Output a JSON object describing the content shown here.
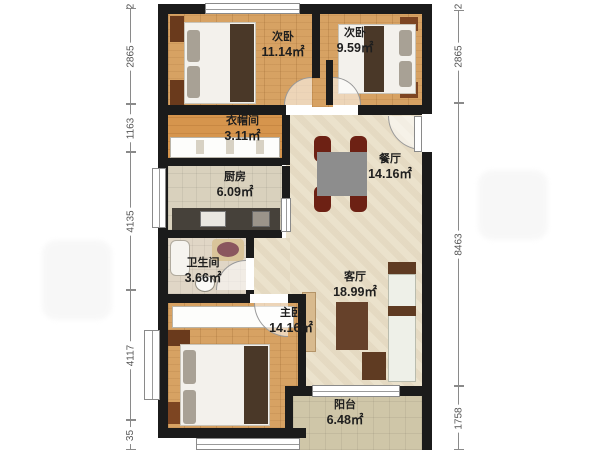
{
  "rooms": [
    {
      "name": "次卧",
      "area": "11.14㎡"
    },
    {
      "name": "次卧",
      "area": "9.59㎡"
    },
    {
      "name": "衣帽间",
      "area": "3.11㎡"
    },
    {
      "name": "厨房",
      "area": "6.09㎡"
    },
    {
      "name": "餐厅",
      "area": "14.16㎡"
    },
    {
      "name": "卫生间",
      "area": "3.66㎡"
    },
    {
      "name": "客厅",
      "area": "18.99㎡"
    },
    {
      "name": "主卧",
      "area": "14.16㎡"
    },
    {
      "name": "阳台",
      "area": "6.48㎡"
    }
  ],
  "dims": {
    "left": [
      "2865",
      "1163",
      "4135",
      "4117",
      "35"
    ],
    "right": [
      "2865",
      "8463",
      "1758"
    ],
    "top_partials": [
      "2",
      "2"
    ]
  },
  "colors": {
    "wall": "#1b1b1b",
    "wood_floor": "#d7a263",
    "tile_floor": "#ebe2cc",
    "kitchen_floor": "#d9d1bd",
    "balcony_floor": "#cfc6a8",
    "furniture_brown": "#6a3a1c",
    "chair_red": "#6d2114",
    "blanket": "#4a3828",
    "dim_text": "#555555"
  }
}
